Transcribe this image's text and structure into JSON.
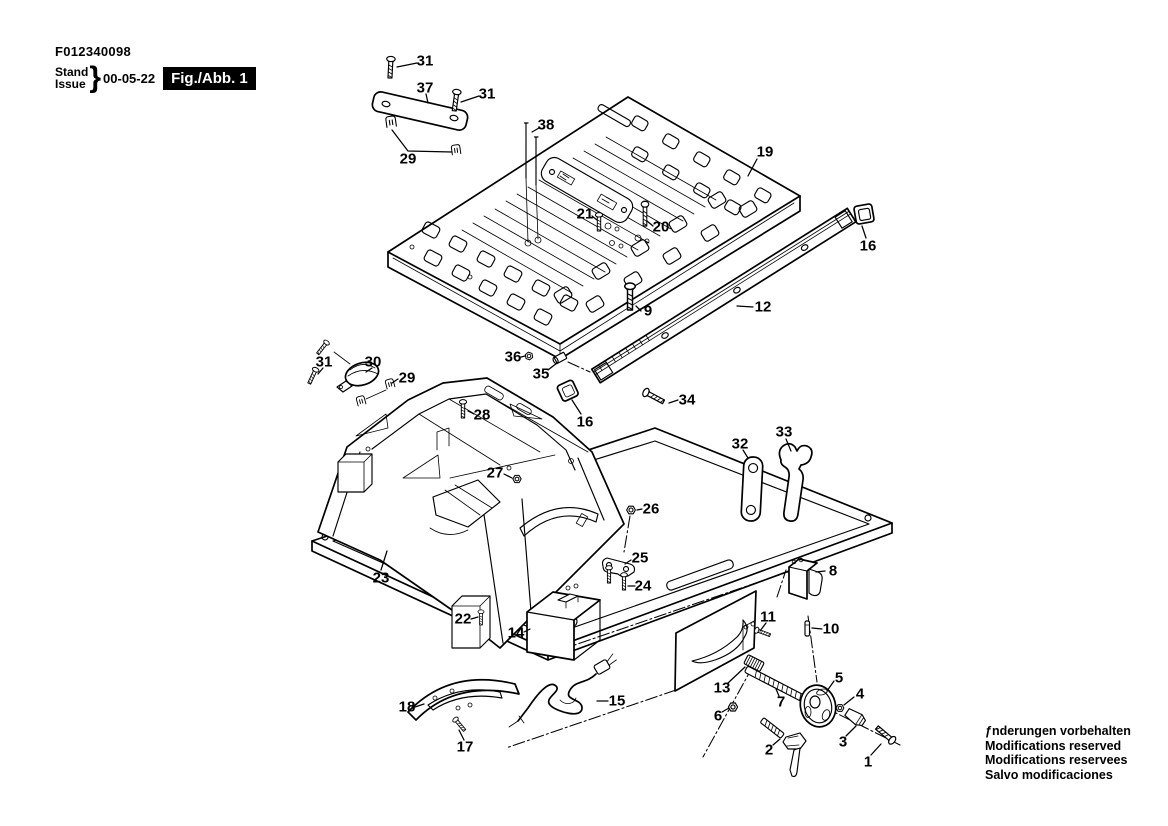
{
  "header": {
    "product_code": "F012340098",
    "stand_label": "Stand",
    "issue_label": "Issue",
    "brace": "}",
    "issue_date": "00-05-22",
    "figure_label": "Fig./Abb. 1"
  },
  "footer": {
    "lines": [
      "ƒnderungen vorbehalten",
      "Modifications reserved",
      "Modifications reservees",
      "Salvo modificaciones"
    ]
  },
  "colors": {
    "ink": "#000000",
    "paper": "#ffffff"
  },
  "callouts": [
    {
      "label": "31",
      "x": 425,
      "y": 61,
      "leader": "417,63 397,67"
    },
    {
      "label": "37",
      "x": 425,
      "y": 88,
      "leader": "426,94 428,103"
    },
    {
      "label": "31",
      "x": 487,
      "y": 94,
      "leader": "479,96 461,102"
    },
    {
      "label": "38",
      "x": 546,
      "y": 125,
      "leader": "539,128 532,132"
    },
    {
      "label": "29",
      "x": 408,
      "y": 159,
      "leader": "392,130 408,151 452,152"
    },
    {
      "label": "19",
      "x": 765,
      "y": 152,
      "leader": "757,159 748,176"
    },
    {
      "label": "21",
      "x": 585,
      "y": 214,
      "leader": "592,216 597,220"
    },
    {
      "label": "20",
      "x": 661,
      "y": 227,
      "leader": "653,226 647,221"
    },
    {
      "label": "16",
      "x": 868,
      "y": 246,
      "leader": "866,238 862,226"
    },
    {
      "label": "9",
      "x": 648,
      "y": 311,
      "leader": "641,311 636,306"
    },
    {
      "label": "12",
      "x": 763,
      "y": 307,
      "leader": "753,307 737,306"
    },
    {
      "label": "36",
      "x": 513,
      "y": 357,
      "leader": "521,357 525,356"
    },
    {
      "label": "35",
      "x": 541,
      "y": 374,
      "leader": "548,370 557,363"
    },
    {
      "label": "31",
      "x": 324,
      "y": 362,
      "leader": "323,368 318,374"
    },
    {
      "label": "30",
      "x": 373,
      "y": 362,
      "leader": "372,368 366,372"
    },
    {
      "label": "29",
      "x": 407,
      "y": 378,
      "leader": "398,379 392,383"
    },
    {
      "label": "16",
      "x": 585,
      "y": 422,
      "leader": "581,414 572,400"
    },
    {
      "label": "34",
      "x": 687,
      "y": 400,
      "leader": "678,400 669,403"
    },
    {
      "label": "28",
      "x": 482,
      "y": 415,
      "leader": "474,414 468,411"
    },
    {
      "label": "32",
      "x": 740,
      "y": 444,
      "leader": "743,450 748,458"
    },
    {
      "label": "33",
      "x": 784,
      "y": 432,
      "leader": "786,439 791,451"
    },
    {
      "label": "27",
      "x": 495,
      "y": 473,
      "leader": "504,474 512,478"
    },
    {
      "label": "26",
      "x": 651,
      "y": 509,
      "leader": "642,509 637,510"
    },
    {
      "label": "23",
      "x": 381,
      "y": 578,
      "leader": "381,570 387,551"
    },
    {
      "label": "25",
      "x": 640,
      "y": 558,
      "leader": "631,560 625,564"
    },
    {
      "label": "24",
      "x": 643,
      "y": 586,
      "leader": "635,586 628,586"
    },
    {
      "label": "8",
      "x": 833,
      "y": 571,
      "leader": "825,571 816,572"
    },
    {
      "label": "22",
      "x": 463,
      "y": 619,
      "leader": "471,619 478,617"
    },
    {
      "label": "14",
      "x": 516,
      "y": 633,
      "leader": "524,632 530,629"
    },
    {
      "label": "11",
      "x": 768,
      "y": 617,
      "leader": "766,623 760,631"
    },
    {
      "label": "10",
      "x": 831,
      "y": 629,
      "leader": "822,629 812,628"
    },
    {
      "label": "13",
      "x": 722,
      "y": 688,
      "leader": "728,683 745,667"
    },
    {
      "label": "5",
      "x": 839,
      "y": 678,
      "leader": "834,681 827,691"
    },
    {
      "label": "7",
      "x": 781,
      "y": 702,
      "leader": "779,696 776,689"
    },
    {
      "label": "6",
      "x": 718,
      "y": 716,
      "leader": "722,712 729,708"
    },
    {
      "label": "4",
      "x": 860,
      "y": 694,
      "leader": "854,697 844,705"
    },
    {
      "label": "18",
      "x": 407,
      "y": 707,
      "leader": "415,707 424,704"
    },
    {
      "label": "15",
      "x": 617,
      "y": 701,
      "leader": "608,701 597,701"
    },
    {
      "label": "17",
      "x": 465,
      "y": 747,
      "leader": "464,740 459,730"
    },
    {
      "label": "2",
      "x": 769,
      "y": 750,
      "leader": "773,745 780,739"
    },
    {
      "label": "3",
      "x": 843,
      "y": 742,
      "leader": "846,736 856,726"
    },
    {
      "label": "1",
      "x": 868,
      "y": 762,
      "leader": "871,755 881,744"
    }
  ]
}
